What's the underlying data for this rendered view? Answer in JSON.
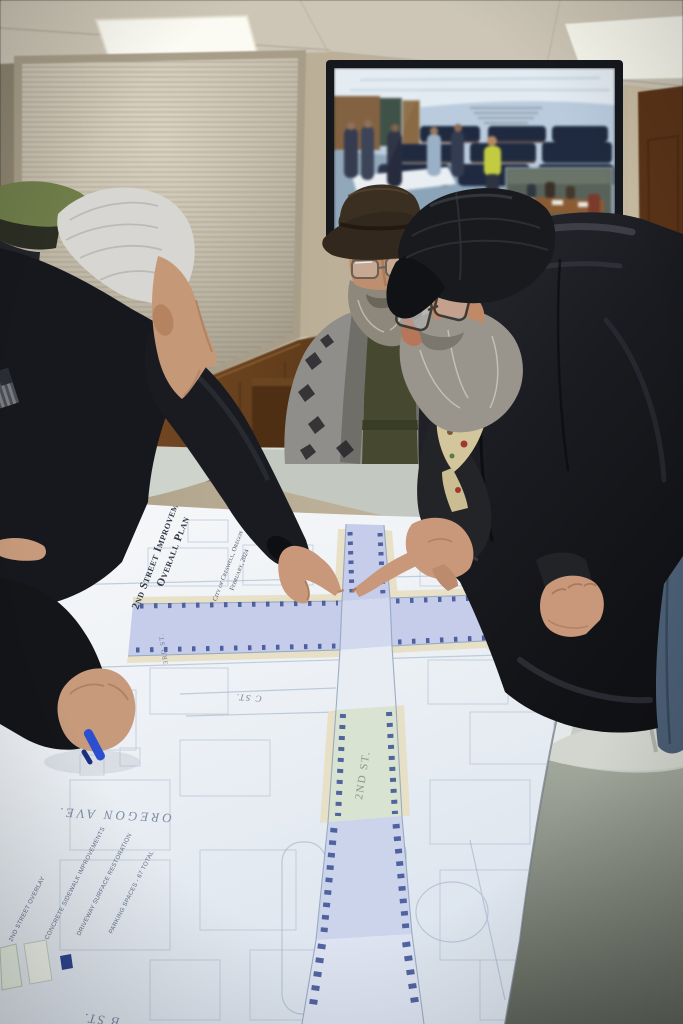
{
  "scene": {
    "alt": "Three older men lean over a large printed street improvement plan spread across gray folding tables in a community meeting room; a wall-mounted TV behind them shows the live video feed of the same room."
  },
  "plan": {
    "title_line_1": "2nd Street Improvements",
    "title_line_2": "Overall Plan",
    "subtitle_line_1": "City of Creswell, Oregon",
    "subtitle_line_2": "February, 2024",
    "street_labels": {
      "oregon_ave": "OREGON AVE.",
      "second_st": "2ND ST.",
      "c_st": "C ST.",
      "third_st": "3RD ST.",
      "d_st": "D ST.",
      "b_st": "B ST."
    },
    "legend_items": [
      "2ND STREET OVERLAY",
      "CONCRETE SIDEWALK IMPROVEMENTS",
      "DRIVEWAY SURFACE RESTORATION",
      "PARKING SPACES - 67 TOTAL"
    ]
  },
  "colors": {
    "paper": "#eef1f5",
    "street_overlay": "#c5cdea",
    "street_green": "#d8e3d2",
    "parking_mark": "#3a4e92",
    "curb_tan": "#e7dfc2",
    "table_gray": "#c6cbc3",
    "phone_red": "#d8372a",
    "pen_blue": "#2b4fd0",
    "leather_black": "#1c1d22"
  }
}
